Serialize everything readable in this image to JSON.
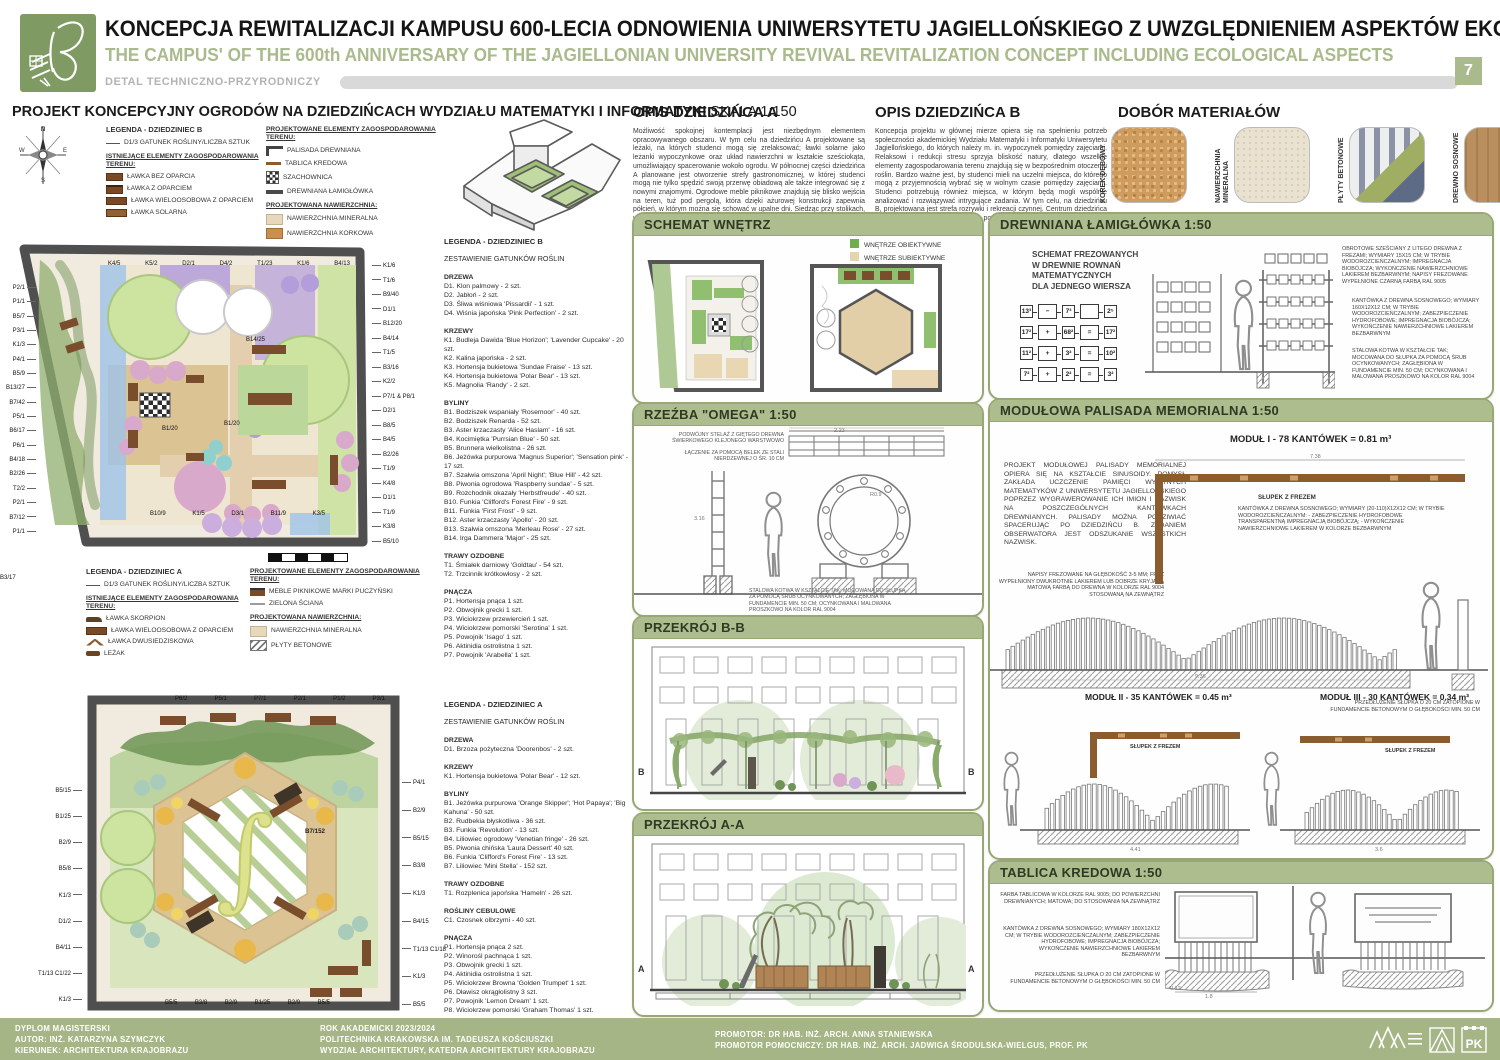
{
  "header": {
    "title_pl": "KONCEPCJA REWITALIZACJI KAMPUSU 600-LECIA ODNOWIENIA UNIWERSYTETU JAGIELLOŃSKIEGO Z UWZGLĘDNIENIEM ASPEKTÓW EKOLOGICZNYCH",
    "title_en": "THE CAMPUS' OF THE 600th ANNIVERSARY OF THE JAGIELLONIAN UNIVERSITY REVIVAL REVITALIZATION CONCEPT INCLUDING ECOLOGICAL ASPECTS",
    "detail_label": "DETAL TECHNICZNO-PRZYRODNICZY",
    "page_number": "7"
  },
  "left": {
    "section_title": "PROJEKT KONCEPCYJNY OGRODÓW NA DZIEDZIŃCACH WYDZIAŁU MATEMATYKI I INFORMATYKI",
    "section_scale": "SKALA 1:150",
    "legend_b": {
      "title": "LEGENDA - DZIEDZINIEC B",
      "species_key": "D1/3  GATUNEK ROŚLINY/LICZBA SZTUK",
      "existing_title": "ISTNIEJĄCE ELEMENTY ZAGOSPODAROWANIA TERENU:",
      "existing": [
        {
          "icon": "bench",
          "label": "ŁAWKA BEZ OPARCIA"
        },
        {
          "icon": "bench-back",
          "label": "ŁAWKA Z OPARCIEM"
        },
        {
          "icon": "bench-multi",
          "label": "ŁAWKA WIELOOSOBOWA Z OPARCIEM"
        },
        {
          "icon": "bench-solar",
          "label": "ŁAWKA SOLARNA"
        }
      ],
      "proposed_title": "PROJEKTOWANE ELEMENTY ZAGOSPODAROWANIA TERENU:",
      "proposed": [
        {
          "icon": "palisade",
          "label": "PALISADA DREWNIANA"
        },
        {
          "icon": "chalk",
          "label": "TABLICA KREDOWA"
        },
        {
          "icon": "checker",
          "label": "SZACHOWNICA"
        },
        {
          "icon": "log",
          "label": "DREWNIANA ŁAMIGŁÓWKA"
        }
      ],
      "surface_title": "PROJEKTOWANA NAWIERZCHNIA:",
      "surfaces": [
        {
          "icon": "mineral",
          "label": "NAWIERZCHNIA MINERALNA"
        },
        {
          "icon": "cork-s",
          "label": "NAWIERZCHNIA KORKOWA"
        }
      ]
    },
    "legend_a": {
      "title": "LEGENDA - DZIEDZINIEC A",
      "species_key": "D1/3  GATUNEK ROŚLINY/LICZBA SZTUK",
      "existing_title": "ISTNIEJĄCE ELEMENTY ZAGOSPODAROWANIA TERENU:",
      "existing": [
        {
          "icon": "bench-scorpion",
          "label": "ŁAWKA SKORPION"
        },
        {
          "icon": "bench-multi",
          "label": "ŁAWKA WIELOOSOBOWA Z OPARCIEM"
        },
        {
          "icon": "bench-double",
          "label": "ŁAWKA DWUSIEDZISKOWA"
        },
        {
          "icon": "lounger",
          "label": "LEŻAK"
        }
      ],
      "proposed_title": "PROJEKTOWANE ELEMENTY ZAGOSPODAROWANIA TERENU:",
      "proposed": [
        {
          "icon": "picnic",
          "label": "MEBLE PIKNIKOWE MARKI PUCZYŃSKI"
        },
        {
          "icon": "greenwall",
          "label": "ZIELONA ŚCIANA"
        }
      ],
      "surface_title": "PROJEKTOWANA NAWIERZCHNIA:",
      "surfaces": [
        {
          "icon": "mineral",
          "label": "NAWIERZCHNIA MINERALNA"
        },
        {
          "icon": "concrete",
          "label": "PŁYTY BETONOWE"
        }
      ]
    },
    "plan_b": {
      "labels_left": [
        "P2/1",
        "P1/1",
        "B5/7",
        "P3/1",
        "K1/3",
        "P4/1",
        "B5/9",
        "B13/27",
        "B7/42",
        "P5/1",
        "B6/17",
        "P6/1",
        "B4/18",
        "B2/26",
        "T2/2",
        "P2/1",
        "B7/12",
        "P1/1"
      ],
      "labels_top": [
        "K4/5",
        "K5/2",
        "D2/1",
        "D4/2",
        "T1/23",
        "K1/6",
        "B4/13"
      ],
      "labels_right": [
        "K1/6",
        "T1/6",
        "B9/40",
        "D1/1",
        "B12/20",
        "B4/14",
        "T1/5",
        "B3/16",
        "K2/2",
        "P7/1 & P8/1",
        "D2/1",
        "B8/5",
        "B4/5",
        "B2/26",
        "T1/9",
        "K4/8",
        "D1/1",
        "T1/9",
        "K3/8",
        "B5/10"
      ],
      "labels_bottom": [
        "B10/9",
        "K1/5",
        "D3/1",
        "B11/9",
        "K3/5"
      ],
      "labels_inner": [
        "B14/25",
        "B1/20",
        "B1/20",
        "B3/17"
      ]
    },
    "plan_a": {
      "labels_top": [
        "P6/2",
        "P5/1",
        "P7/1",
        "P2/1",
        "P1/2",
        "P3/1"
      ],
      "labels_left": [
        "B5/15",
        "B1/25",
        "B2/9",
        "B5/8",
        "K1/3",
        "D1/2",
        "B4/11",
        "T1/13 C1/22",
        "K1/3"
      ],
      "labels_right": [
        "P4/1",
        "B2/9",
        "B5/15",
        "B3/8",
        "K1/3",
        "B4/15",
        "T1/13 C1/18",
        "K1/3",
        "B5/5"
      ],
      "labels_bottom": [
        "B5/5",
        "B3/8",
        "B2/9",
        "B1/25",
        "B2/9",
        "B5/5"
      ],
      "label_center": "B7/152"
    }
  },
  "species_b": {
    "title": "LEGENDA - DZIEDZINIEC B",
    "subtitle": "ZESTAWIENIE GATUNKÓW ROŚLIN",
    "groups": [
      {
        "name": "DRZEWA",
        "items": [
          "D1. Klon palmowy - 2 szt.",
          "D2. Jabłoń - 2 szt.",
          "D3. Śliwa wiśniowa 'Pissardii' - 1 szt.",
          "D4. Wiśnia japońska 'Pink Perfection' - 2 szt."
        ]
      },
      {
        "name": "KRZEWY",
        "items": [
          "K1. Budleja Dawida 'Blue Horizon'; 'Lavender Cupcake' - 20 szt.",
          "K2. Kalina japońska - 2 szt.",
          "K3. Hortensja bukietowa 'Sundae Fraise' - 13 szt.",
          "K4. Hortensja bukietowa 'Polar Bear' - 13 szt.",
          "K5. Magnolia 'Randy' - 2 szt."
        ]
      },
      {
        "name": "BYLINY",
        "items": [
          "B1. Bodziszek wspaniały 'Rosemoor' - 40 szt.",
          "B2. Bodziszek Renarda - 52 szt.",
          "B3. Aster krzaczasty 'Alice Haslam' - 16 szt.",
          "B4. Kocimiętka 'Purrsian Blue' - 50 szt.",
          "B5. Brunnera wielkolistna - 26 szt.",
          "B6. Jeżówka purpurowa 'Magnus Superior'; 'Sensation pink' - 17 szt.",
          "B7. Szałwia omszona 'April Night'; 'Blue Hill' - 42 szt.",
          "B8. Piwonia ogrodowa 'Raspberry sundae' - 5 szt.",
          "B9. Rozchodnik okazały 'Herbstfreude' - 40 szt.",
          "B10. Funkia 'Clifford's Forest Fire' - 9 szt.",
          "B11. Funkia 'First Frost' - 9 szt.",
          "B12. Aster krzaczasty 'Apollo' - 20 szt.",
          "B13. Szałwia omszona 'Merleau Rose' - 27 szt.",
          "B14. Irga Dammera 'Major' - 25 szt."
        ]
      },
      {
        "name": "TRAWY OZDOBNE",
        "items": [
          "T1. Śmiałek darniowy 'Goldtau' - 54 szt.",
          "T2. Trzcinnik krótkowłosy - 2 szt."
        ]
      },
      {
        "name": "PNĄCZA",
        "items": [
          "P1. Hortensja pnąca 1 szt.",
          "P2. Obwojnik grecki 1 szt.",
          "P3. Wiciokrzew przewiercień 1 szt.",
          "P4. Wiciokrzew pomorski 'Serotina' 1 szt.",
          "P5. Powojnik 'Isago' 1 szt.",
          "P6. Aktinidia ostrolistna 1 szt.",
          "P7. Powojnik 'Arabella' 1 szt."
        ]
      }
    ]
  },
  "species_a": {
    "title": "LEGENDA - DZIEDZINIEC A",
    "subtitle": "ZESTAWIENIE GATUNKÓW ROŚLIN",
    "groups": [
      {
        "name": "DRZEWA",
        "items": [
          "D1. Brzoza pożyteczna 'Doorenbos' - 2 szt."
        ]
      },
      {
        "name": "KRZEWY",
        "items": [
          "K1. Hortensja bukietowa 'Polar Bear' - 12 szt."
        ]
      },
      {
        "name": "BYLINY",
        "items": [
          "B1. Jeżówka purpurowa 'Orange Skipper'; 'Hot Papaya'; 'Big Kahuna' - 50 szt.",
          "B2. Rudbekia błyskotliwa - 36 szt.",
          "B3. Funkia 'Revolution' - 13 szt.",
          "B4. Liliowiec ogrodowy 'Venetian fringe' - 26 szt.",
          "B5. Piwonia chińska 'Laura Dessert' 40 szt.",
          "B6. Funkia 'Clifford's Forest Fire' - 13 szt.",
          "B7. Liliowiec 'Mini Stella' - 152 szt."
        ]
      },
      {
        "name": "TRAWY OZDOBNE",
        "items": [
          "T1. Rozplenica japońska 'Hameln' - 26 szt."
        ]
      },
      {
        "name": "ROŚLINY CEBULOWE",
        "items": [
          "C1. Czosnek olbrzymi - 40 szt."
        ]
      },
      {
        "name": "PNĄCZA",
        "items": [
          "P1. Hortensja pnąca 2 szt.",
          "P2. Winorośl pachnąca 1 szt.",
          "P3. Obwojnik grecki 1 szt.",
          "P4. Aktinidia ostrolistna 1 szt.",
          "P5. Wiciokrzew Browna 'Golden Trumpet' 1 szt.",
          "P6. Dławisz okrągłolistny 3 szt.",
          "P7. Powojnik 'Lemon Dream' 1 szt.",
          "P8. Wiciokrzew pomorski 'Graham Thomas' 1 szt."
        ]
      }
    ]
  },
  "opis_a": {
    "title": "OPIS DZIEDZIŃCA A",
    "text": "Możliwość spokojnej kontemplacji jest niezbędnym elementem opracowywanego obszaru. W tym celu na dziedzińcu A projektowane są leżaki, na których studenci mogą się zrelaksować; ławki solarne jako leżanki wypoczynkowe oraz układ nawierzchni w kształcie sześciokąta, umożliwiający spacerowanie wokoło ogrodu. W północnej części dziedzińca A planowane jest otworzenie strefy gastronomicznej, w której studenci mogą nie tylko spędzić swoją przerwę obiadową ale także integrować się z nowymi znajomymi. Ogrodowe meble piknikowe znajdują się blisko wejścia na teren, tuż pod pergolą, która dzięki ażurowej konstrukcji zapewnia półcień, w którym można się schować w upalne dni. Siedząc przy stolikach, użytkownik ma także doskonały widok na cały ogród. Rabata znajdująca się w centrum dziedzińca A wykreślona jest na kształt całki."
  },
  "opis_b": {
    "title": "OPIS DZIEDZIŃCA B",
    "text": "Koncepcja projektu w głównej mierze opiera się na spełnieniu potrzeb społeczności akademickiej Wydziału Matematyki i Informatyki Uniwersytetu Jagiellońskiego, do których należy m. in. wypoczynek pomiędzy zajęciami. Relaksowi i redukcji stresu sprzyja bliskość natury, dlatego wszelkie elementy zagospodarowania terenu znajdują się w bezpośrednim otoczeniu roślin. Bardzo ważne jest, by studenci mieli na uczelni miejsca, do którego mogą z przyjemnością wybrać się w wolnym czasie pomiędzy zajęciami. Studenci potrzebują również miejsca, w którym będą mogli wspólnie analizować i rozwiązywać intrygujące zadania. W tym celu, na dziedzińcu B, projektowana jest strefa rozrywki i rekreacji czynnej. Centrum dziedzińca B podkreślone jest akcentem w postaci drewnianej rzeźby w kształcie greckiej litery omega."
  },
  "materials": {
    "title": "DOBÓR MATERIAŁÓW",
    "items": [
      {
        "icon": "cork",
        "label": "KOREK DĘBOWY",
        "color": "#cf9c5f"
      },
      {
        "icon": "mineral-big",
        "label": "NAWIERZCHNIA MINERALNA",
        "color": "#eae2d0"
      },
      {
        "icon": "plates",
        "label": "PŁYTY BETONOWE",
        "color": "#8b92a6"
      },
      {
        "icon": "pine",
        "label": "DREWNO SOSNOWE",
        "color": "#b98f5e"
      }
    ]
  },
  "schemat": {
    "title": "SCHEMAT WNĘTRZ",
    "legend": [
      {
        "label": "WNĘTRZE OBIEKTYWNE",
        "color": "#6fae4e"
      },
      {
        "label": "WNĘTRZE SUBIEKTYWNE",
        "color": "#e5d4ad"
      }
    ]
  },
  "omega": {
    "title": "RZEŹBA \"OMEGA\" 1:50",
    "ann_top_1": "PODWÓJNY STELAŻ Z GIĘTEGO DREWNA ŚWIERKOWEGO KLEJONEGO WARSTWOWO",
    "ann_top_2": "ŁĄCZENIE ZA POMOCĄ BELEK ZE STALI NIERDZEWNEJ O ŚR. 10 CM",
    "ann_bottom": "STALOWA KOTWA W KSZTAŁCIE TAK; MOCOWANA DO SŁUPKA ZA POMOCĄ ŚRUB OCYNKOWANYCH; ZAGŁĘBIONA W FUNDAMENCIE MIN. 50 CM; OCYNKOWANA I MALOWANA PROSZKOWO NA KOLOR RAL 9004",
    "dim_w": "2.23",
    "dim_h": "3.16",
    "dim_r": "R0.9",
    "dim_f": "0.74"
  },
  "przekroj_bb": {
    "title": "PRZEKRÓJ B-B",
    "marker": "B"
  },
  "przekroj_aa": {
    "title": "PRZEKRÓJ A-A",
    "marker": "A"
  },
  "lamiglowka": {
    "title": "DREWNIANA ŁAMIGŁÓWKA 1:50",
    "schema_text_1": "SCHEMAT FREZOWANYCH",
    "schema_text_2": "W DREWNIE ROWNAŃ",
    "schema_text_3": "MATEMATYCZNYCH",
    "schema_text_4": "DLA JEDNEGO WIERSZA",
    "equations": [
      [
        "13³",
        "−",
        "7³",
        "",
        "2⁵"
      ],
      [
        "17²",
        "+",
        "68²",
        "=",
        "17²"
      ],
      [
        "11²",
        "+",
        "3²",
        "=",
        "10²"
      ],
      [
        "7²",
        "+",
        "2²",
        "=",
        "3²"
      ]
    ],
    "ann_1": "OBROTOWE SZEŚCIANY Z LITEGO DREWNA Z FREZAMI; WYMIARY 15X15 CM; W TRYBIE WODOROZCIEŃCZALNYM; IMPREGNACJA BIOBÓJCZA; WYKOŃCZENIE NAWIERZCHNIOWE LAKIEREM BEZBARWNYM; NAPISY FREZOWANE WYPEŁNIONE CZARNĄ FARBĄ RAL 9005",
    "ann_2": "KANTÓWKA Z DREWNA SOSNOWEGO; WYMIARY 160X12X12 CM; W TRYBIE WODOROZCIEŃCZALNYM; ZABEZPIECZENIE HYDROFOBOWE; IMPREGNACJA BIOBÓJCZA; WYKOŃCZENIE NAWIERZCHNIOWE LAKIEREM BEZBARWNYM",
    "ann_3": "STALOWA KOTWA W KSZTAŁCIE TAK; MOCOWANA DO SŁUPKA ZA POMOCĄ ŚRUB OCYNKOWANYCH; ZAGŁĘBIONA W FUNDAMENCIE MIN. 50 CM; OCYNKOWANA I MALOWANA PROSZKOWO NA KOLOR RAL 9004"
  },
  "palisada": {
    "title": "MODUŁOWA PALISADA MEMORIALNA 1:50",
    "module_1": "MODUŁ I - 78 KANTÓWEK = 0.81 m³",
    "module_2": "MODUŁ II - 35 KANTÓWEK = 0.45 m³",
    "module_3": "MODUŁ III - 30 KANTÓWEK = 0.34 m³",
    "description": "PROJEKT MODUŁOWEJ PALISADY MEMORIALNEJ OPIERA SIĘ NA KSZTAŁCIE SINUSOIDY. POMYSŁ ZAKŁADA UCZCZENIE PAMIĘCI WYBITNYCH MATEMATYKÓW Z UNIWERSYTETU JAGIELLOŃSKIEGO POPRZEZ WYGRAWEROWANIE ICH IMION I NAZWISK NA POSZCZEGÓLNYCH KANTÓWKACH DREWNIANYCH. PALISADY MOŻNA PODZIWIAĆ SPACERUJĄC PO DZIEDZIŃCU B. ZADANIEM OBSERWATORA JEST ODSZUKANIE WSZYSTKICH NAZWISK.",
    "ann_frez": "NAPISY FREZOWANE NA GŁĘBOKOŚĆ 3-5 MM; FREZ WYPEŁNIONY DWUKROTNIE LAKIEREM LUB DOBRZE KRYJĄCĄ MATOWĄ FARBĄ DO DREWNA W KOLORZE RAL 9004 STOSOWANĄ NA ZEWNĄTRZ",
    "ann_slupek": "SŁUPEK Z FREZEM",
    "ann_kantowka": "KANTÓWKA Z DREWNA SOSNOWEGO; WYMIARY (20-110)X12X12 CM; W TRYBIE WODOROZCIEŃCZALNYM: - ZABEZPIECZENIE HYDROFOBOWE TRANSPARENTNĄ IMPREGNACJĄ BIOBÓJCZĄ; - WYKOŃCZENIE NAWIERZCHNIOWE LAKIEREM W KOLORZE BEZBARWNYM",
    "ann_fundament": "PRZEDŁUŻENIE SŁUPKA O 20 CM ZATOPIONE W FUNDAMENCIE BETONOWYM O GŁĘBOKOŚCI MIN. 50 CM",
    "dim_1_top": "7.38",
    "dim_1_bottom": "9.36",
    "dim_2": "4.41",
    "dim_3": "3.6"
  },
  "tablica": {
    "title": "TABLICA KREDOWA 1:50",
    "ann_1": "FARBA TABLICOWA W KOLORZE RAL 9005; DO POWIERZCHNI DREWNIANYCH; MATOWA; DO STOSOWANIA NA ZEWNĄTRZ",
    "ann_2": "KANTÓWKA Z DREWNA SOSNOWEGO; WYMIARY 180X12X12 CM; W TRYBIE WODOROZCIEŃCZALNYM; ZABEZPIECZENIE HYDROFOBOWE; IMPREGNACJA BIOBÓJCZA; WYKOŃCZENIE NAWIERZCHNIOWE LAKIEREM BEZBARWNYM",
    "ann_3": "PRZEDŁUŻENIE SŁUPKA O 20 CM ZATOPIONE W FUNDAMENCIE BETONOWYM O GŁĘBOKOŚCI MIN. 50 CM",
    "dim_w": "1.8",
    "dim_s": "0.12"
  },
  "footer": {
    "col1": [
      "DYPLOM MAGISTERSKI",
      "AUTOR: INŻ. KATARZYNA SZYMCZYK",
      "KIERUNEK: ARCHITEKTURA KRAJOBRAZU"
    ],
    "col2": [
      "ROK AKADEMICKI 2023/2024",
      "POLITECHNIKA KRAKOWSKA IM. TADEUSZA KOŚCIUSZKI",
      "WYDZIAŁ ARCHITEKTURY, KATEDRA ARCHITEKTURY KRAJOBRAZU"
    ],
    "col3": [
      "PROMOTOR: DR HAB. INŻ. ARCH. ANNA STANIEWSKA",
      "PROMOTOR POMOCNICZY: DR HAB. INŻ. ARCH. JADWIGA ŚRODULSKA-WIELGUS, PROF. PK"
    ],
    "logo_pk": "PK"
  }
}
